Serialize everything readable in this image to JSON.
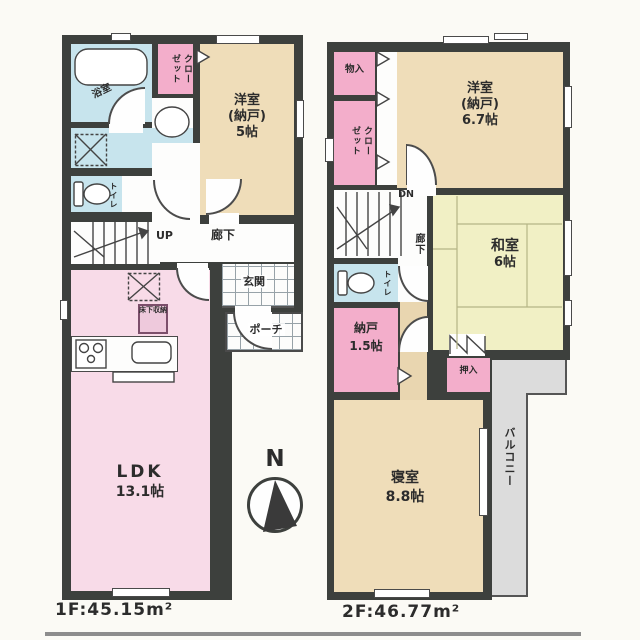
{
  "colors": {
    "wall": "#3d403d",
    "pink": "#f3aecb",
    "ldk_pink": "#f8dbe8",
    "beige": "#efddb9",
    "tatami": "#f1f0c5",
    "water": "#c7e4ed",
    "tan": "#e9d6b0",
    "balcony": "#dcdcdc"
  },
  "floor1": {
    "area_label": "1F:45.15m²",
    "bath": "浴室",
    "closet": "クローゼット",
    "western_room_l1": "洋室",
    "western_room_l2": "(納戸)",
    "western_room_l3": "5帖",
    "toilet": "トイレ",
    "stairs": "UP",
    "hallway": "廊下",
    "entrance": "玄関",
    "porch": "ポーチ",
    "ldk_l1": "LDK",
    "ldk_l2": "13.1帖",
    "underfloor_storage": "床下収納"
  },
  "floor2": {
    "area_label": "2F:46.77m²",
    "storage_in": "物入",
    "closet": "クローゼット",
    "western_room_l1": "洋室",
    "western_room_l2": "(納戸)",
    "western_room_l3": "6.7帖",
    "stairs": "DN",
    "hallway": "廊下",
    "japanese_room_l1": "和室",
    "japanese_room_l2": "6帖",
    "toilet": "トイレ",
    "storage_l1": "納戸",
    "storage_l2": "1.5帖",
    "oshiire": "押入",
    "bedroom_l1": "寝室",
    "bedroom_l2": "8.8帖",
    "balcony": "バルコニー"
  },
  "compass": {
    "north": "N"
  }
}
